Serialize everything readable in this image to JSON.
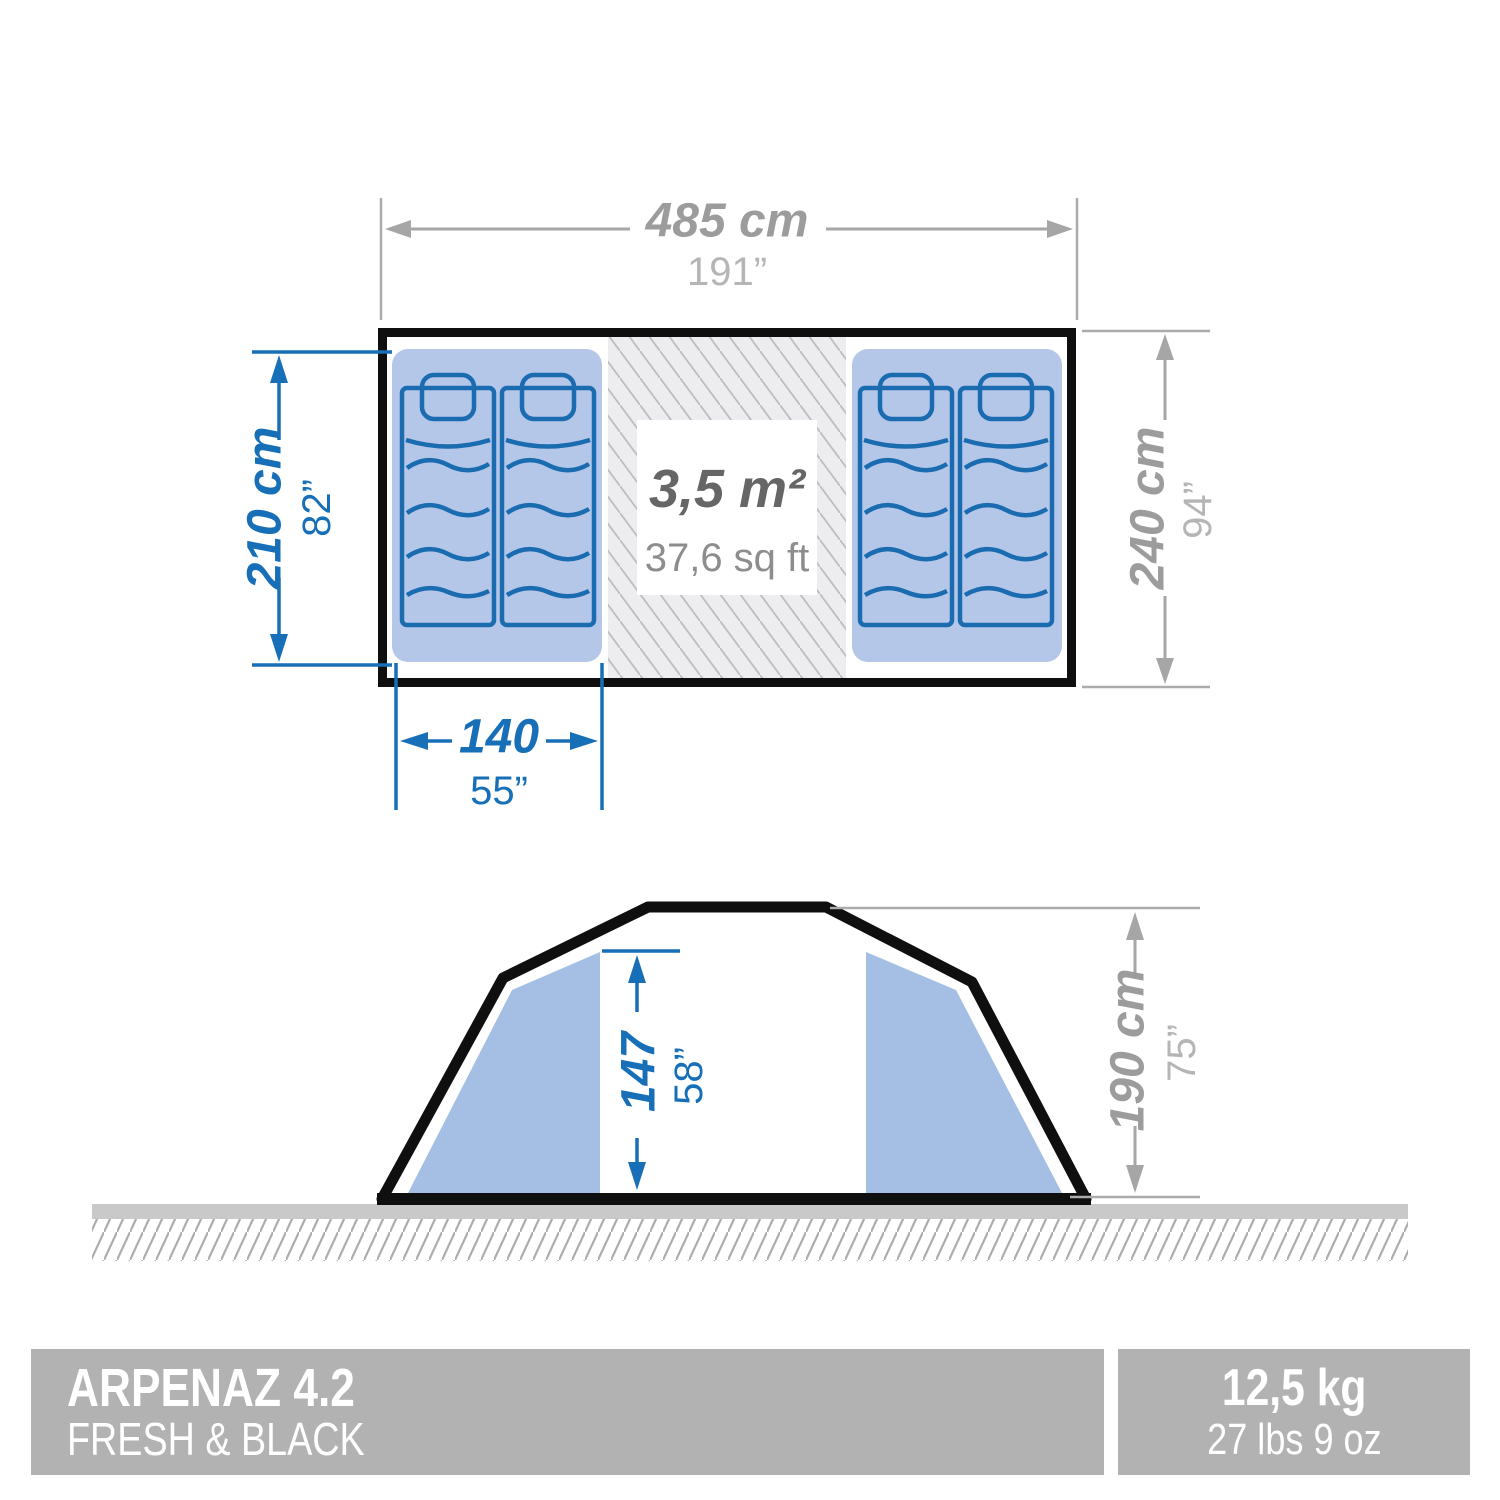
{
  "floor_plan": {
    "width": {
      "cm": "485 cm",
      "in": "191”"
    },
    "depth": {
      "cm": "240 cm",
      "in": "94”"
    },
    "bedroom_length": {
      "cm": "210 cm",
      "in": "82”"
    },
    "bedroom_width": {
      "cm": "140",
      "in": "55”"
    },
    "living_area": {
      "m2": "3,5 m²",
      "sqft": "37,6 sq ft"
    }
  },
  "side_view": {
    "interior_height": {
      "cm": "147",
      "in": "58”"
    },
    "exterior_height": {
      "cm": "190 cm",
      "in": "75”"
    }
  },
  "footer": {
    "model": "ARPENAZ 4.2",
    "line": "FRESH & BLACK",
    "weight_kg": "12,5 kg",
    "weight_lb": "27 lbs 9 oz"
  },
  "colors": {
    "dimension_blue": "#176fb7",
    "dimension_gray": "#a6a6a6",
    "bedroom_fill": "#b4c7e9",
    "panel_fill": "#a5bfe4",
    "mattress_fill": "#dce6f6",
    "living_hatch_bg": "#ededef",
    "footer_bar": "#b2b2b2",
    "outline_black": "#0f0f0f"
  }
}
